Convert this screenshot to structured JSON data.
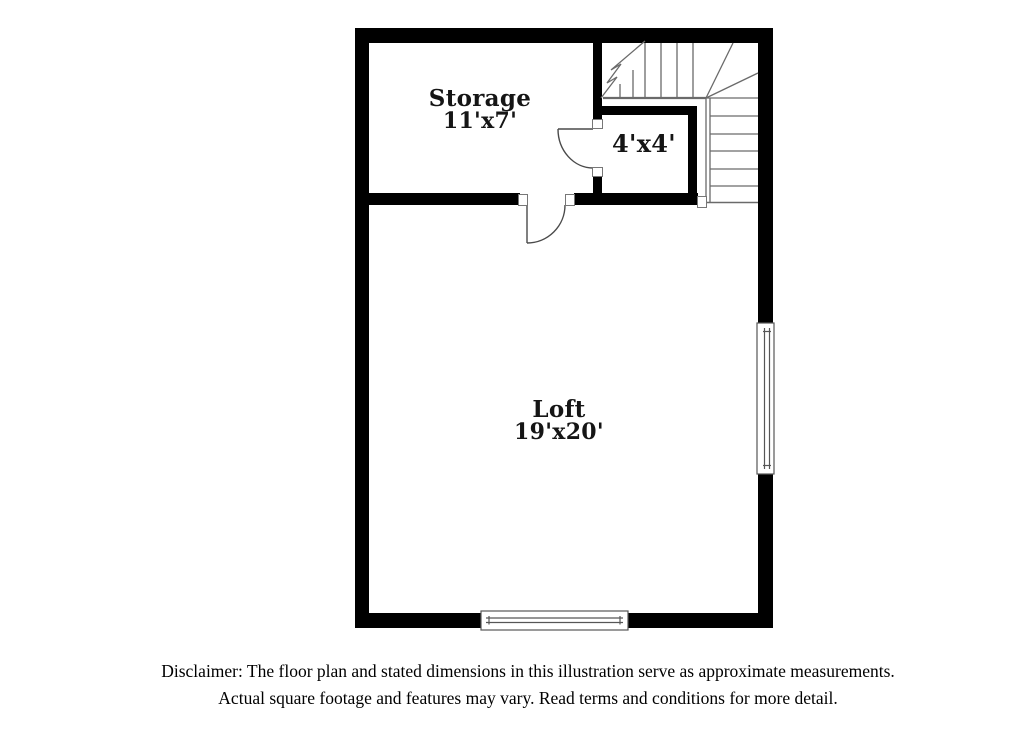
{
  "rooms": {
    "storage": {
      "name": "Storage",
      "dims": "11'x7'"
    },
    "closet": {
      "dims": "4'x4'"
    },
    "loft": {
      "name": "Loft",
      "dims": "19'x20'"
    }
  },
  "disclaimer": {
    "line1": "Disclaimer: The floor plan and stated dimensions in this illustration serve as approximate measurements.",
    "line2": "Actual square footage and features may vary. Read terms and conditions for more detail."
  },
  "colors": {
    "wall": "#000000",
    "linework": "#6a6a6a",
    "door_line": "#4a4a4a",
    "label_text": "#151515",
    "background": "#ffffff"
  }
}
